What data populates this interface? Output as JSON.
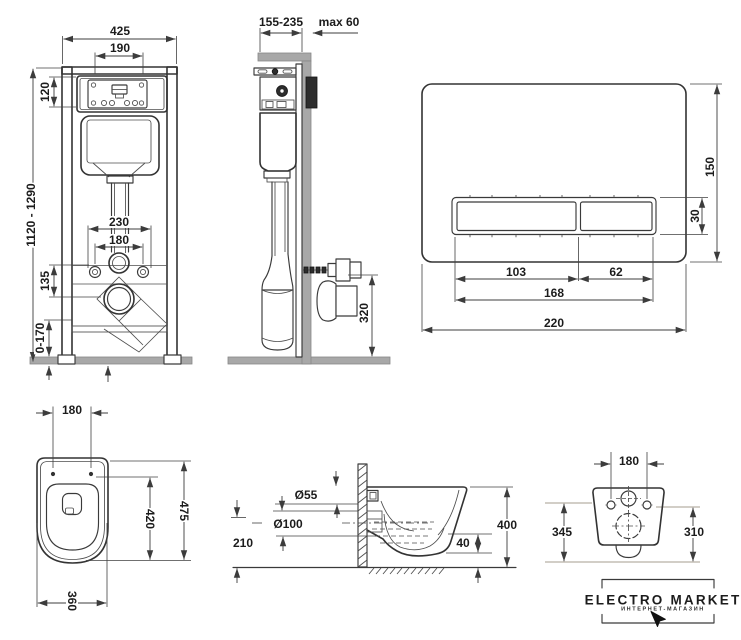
{
  "colors": {
    "background": "#ffffff",
    "line": "#333333",
    "dimension": "#3c3c3c",
    "gray_fill": "#a8a8a8",
    "dark_block": "#2d2d2d",
    "reference_line": "#a59c8f"
  },
  "front_view": {
    "dims": {
      "width": "425",
      "inner_width": "190",
      "height_range": "1120 - 1290",
      "panel_height": "120",
      "spacing_230": "230",
      "spacing_180": "180",
      "offset_135": "135",
      "adjust_range": "0-170"
    }
  },
  "side_view": {
    "dims": {
      "depth_range": "155-235",
      "wall_max": "max 60",
      "outlet_height": "320"
    }
  },
  "flush_plate": {
    "dims": {
      "height": "150",
      "button_height": "30",
      "button_large": "103",
      "button_small": "62",
      "buttons_width": "168",
      "width": "220"
    }
  },
  "top_view": {
    "dims": {
      "bolt_spacing": "180",
      "length": "475",
      "bolt_to_front": "420",
      "width": "360"
    }
  },
  "profile_view": {
    "dims": {
      "inlet_diameter": "Ø55",
      "outlet_diameter": "Ø100",
      "outlet_height": "210",
      "total_height": "400",
      "rim_height": "40"
    }
  },
  "back_view": {
    "dims": {
      "bolt_spacing": "180",
      "height_left": "345",
      "height_right": "310"
    }
  },
  "logo": {
    "title": "ELECTRO MARKET",
    "subtitle": "ИНТЕРНЕТ-МАГАЗИН"
  }
}
